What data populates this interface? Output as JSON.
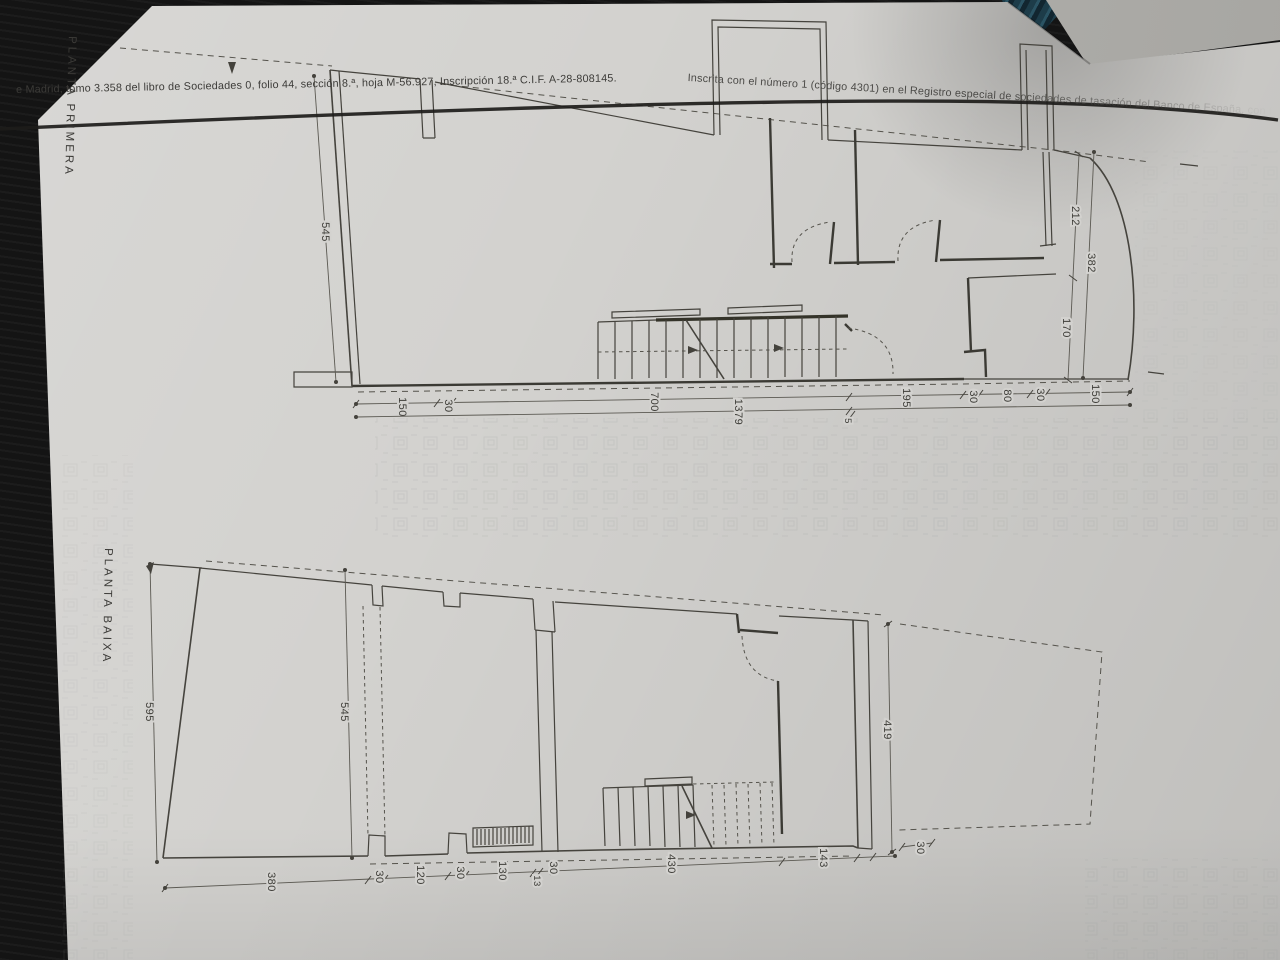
{
  "header": {
    "left": "e Madrid, tomo 3.358 del libro de Sociedades 0, folio 44, sección 8.ª, hoja M-56.927, Inscripción 18.ª    C.I.F. A-28-808145.",
    "right": "Inscrita con el número 1 (código 4301) en el Registro especial de sociedades de tasación del Banco de España, con fecha"
  },
  "plans": {
    "primera": {
      "title": "PLANTA PRIMERA",
      "dim_left": "545",
      "bottom": [
        "150",
        "30",
        "700",
        "195",
        "30",
        "80",
        "30",
        "150"
      ],
      "bottom_total": "1379",
      "bottom_small": "5",
      "right": [
        "212",
        "170"
      ],
      "right_total": "382"
    },
    "baixa": {
      "title": "PLANTA BAIXA",
      "dim_outer_left": "595",
      "dim_left": "545",
      "bottom": [
        "380",
        "30",
        "120",
        "30",
        "130",
        "13",
        "30",
        "430",
        "143",
        "30"
      ],
      "dim_right": "419"
    }
  }
}
